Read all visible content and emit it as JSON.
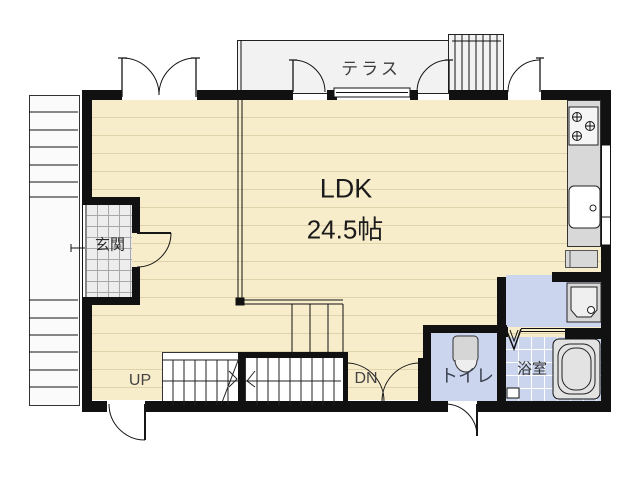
{
  "floor_plan": {
    "terrace_label": "テラス",
    "ldk": {
      "label": "LDK",
      "size": "24.5帖"
    },
    "entrance_label": "玄関",
    "stairs_up_label": "UP",
    "stairs_down_label": "DN",
    "toilet_label": "トイレ",
    "bathroom_label": "浴室",
    "colors": {
      "wall": "#111111",
      "ldk_floor": "#f8edcb",
      "ldk_floor_stripe": "#e0d3ab",
      "wet_room_floor": "#ccd5ee",
      "entrance_tile": "#ededed",
      "terrace_floor": "#f2f2f2",
      "counter": "#d8d8d8"
    }
  }
}
